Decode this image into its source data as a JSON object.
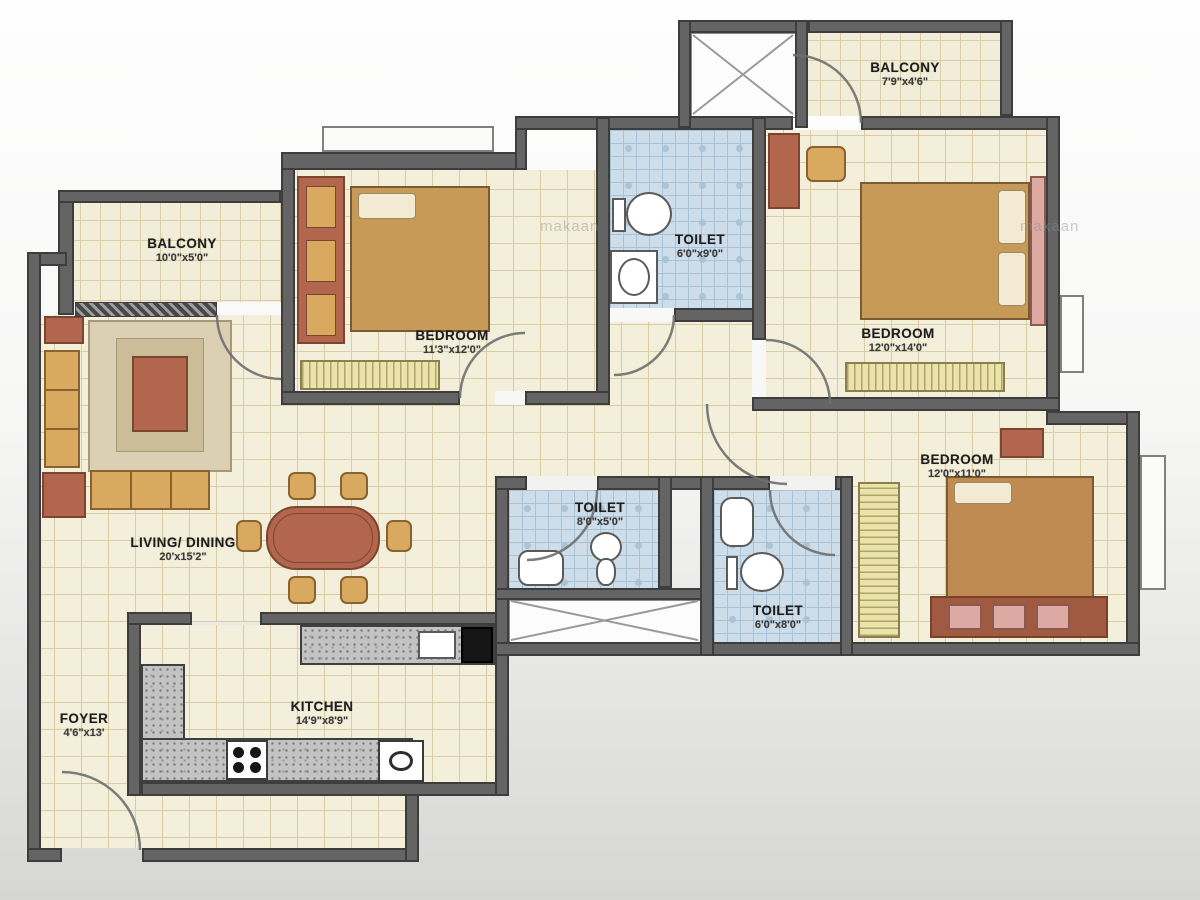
{
  "watermark": "makaan",
  "colors": {
    "wall": "#646464",
    "wall_edge": "#3d3d3d",
    "floor": "#f4efda",
    "floor_grid": "#d8cda4",
    "toilet_floor": "#cdddea",
    "toilet_grid": "#a9c3d6",
    "furniture_tan": "#d8a95f",
    "furniture_redbrown": "#b2664e",
    "bench_yellow": "#eae3aa",
    "counter_gray": "#c3c3c3",
    "headboard_pink": "#dcaaa2"
  },
  "rooms": [
    {
      "name": "BALCONY",
      "dims": "10'0\"x5'0\""
    },
    {
      "name": "BEDROOM",
      "dims": "11'3\"x12'0\""
    },
    {
      "name": "TOILET",
      "dims": "6'0\"x9'0\""
    },
    {
      "name": "BALCONY",
      "dims": "7'9\"x4'6\""
    },
    {
      "name": "BEDROOM",
      "dims": "12'0\"x14'0\""
    },
    {
      "name": "LIVING/ DINING",
      "dims": "20'x15'2\""
    },
    {
      "name": "TOILET",
      "dims": "8'0\"x5'0\""
    },
    {
      "name": "TOILET",
      "dims": "6'0\"x8'0\""
    },
    {
      "name": "BEDROOM",
      "dims": "12'0\"x11'0\""
    },
    {
      "name": "KITCHEN",
      "dims": "14'9\"x8'9\""
    },
    {
      "name": "FOYER",
      "dims": "4'6\"x13'"
    }
  ]
}
